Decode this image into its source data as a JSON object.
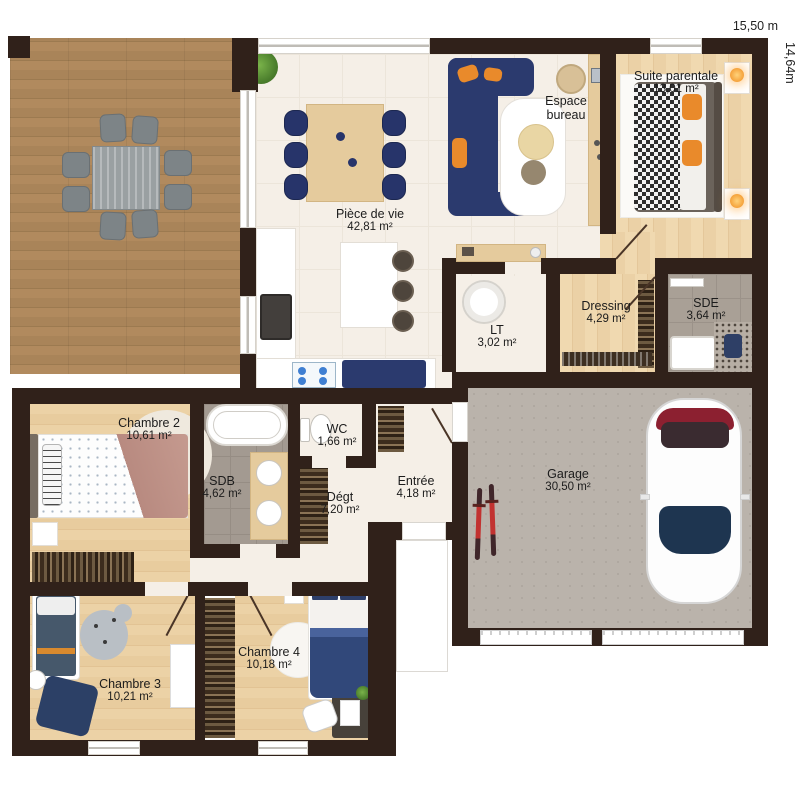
{
  "dimensions": {
    "width_label": "15,50 m",
    "depth_label": "14,64m"
  },
  "rooms": [
    {
      "id": "piece-de-vie",
      "name": "Pièce de vie",
      "area": "42,81 m²"
    },
    {
      "id": "suite-parentale",
      "name": "Suite parentale",
      "area": "13,01 m²"
    },
    {
      "id": "espace-bureau",
      "name": "Espace bureau",
      "area": ""
    },
    {
      "id": "dressing",
      "name": "Dressing",
      "area": "4,29 m²"
    },
    {
      "id": "sde",
      "name": "SDE",
      "area": "3,64 m²"
    },
    {
      "id": "lt",
      "name": "LT",
      "area": "3,02 m²"
    },
    {
      "id": "chambre-2",
      "name": "Chambre 2",
      "area": "10,61 m²"
    },
    {
      "id": "wc",
      "name": "WC",
      "area": "1,66 m²"
    },
    {
      "id": "sdb",
      "name": "SDB",
      "area": "4,62 m²"
    },
    {
      "id": "degt",
      "name": "Dégt",
      "area": "7,20 m²"
    },
    {
      "id": "entree",
      "name": "Entrée",
      "area": "4,18 m²"
    },
    {
      "id": "garage",
      "name": "Garage",
      "area": "30,50 m²"
    },
    {
      "id": "chambre-3",
      "name": "Chambre 3",
      "area": "10,21 m²"
    },
    {
      "id": "chambre-4",
      "name": "Chambre 4",
      "area": "10,18 m²"
    }
  ],
  "colors": {
    "wall": "#30211a",
    "terrace_wood": "#ab865c",
    "interior_floor": "#f5efe7",
    "bedroom_wood": "#e8cda1",
    "sofa_navy": "#2b3a6e",
    "accent_orange": "#e98a2b",
    "garage_concrete": "#bab3ab",
    "tile_gray": "#a9a096",
    "car_detail_red": "#8c2030",
    "bike_red": "#c23230",
    "label_text": "#1c1c1c"
  }
}
